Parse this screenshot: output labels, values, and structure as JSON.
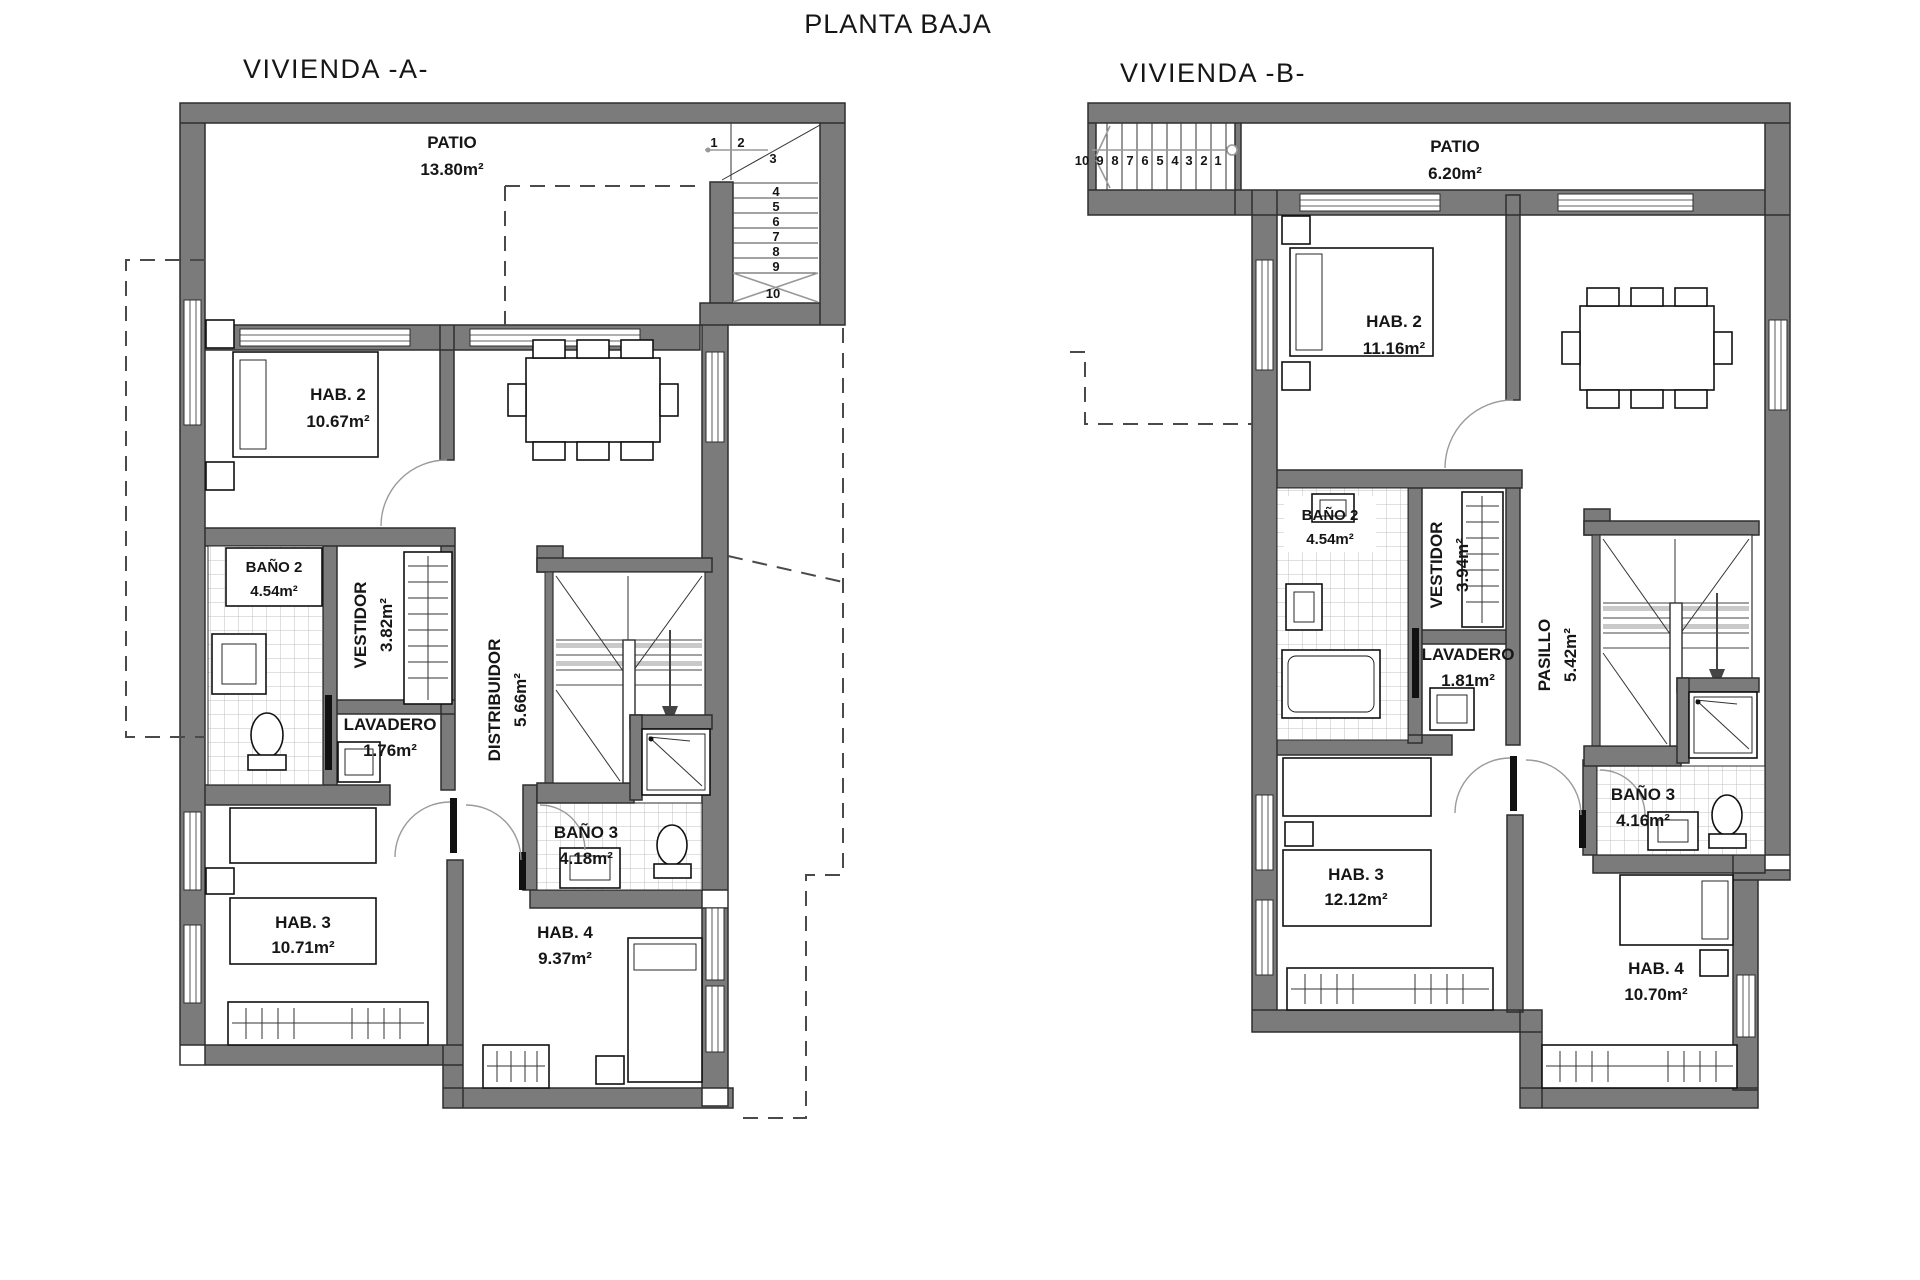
{
  "title": "PLANTA BAJA",
  "plan_a": {
    "title": "VIVIENDA -A-",
    "rooms": {
      "patio": {
        "name": "PATIO",
        "area": "13.80m²"
      },
      "hab2": {
        "name": "HAB. 2",
        "area": "10.67m²"
      },
      "comedor": {
        "name": "COMEDOR",
        "area": "12.06m²"
      },
      "bano2": {
        "name": "BAÑO 2",
        "area": "4.54m²"
      },
      "vestidor": {
        "name": "VESTIDOR",
        "area": "3.82m²"
      },
      "lavadero": {
        "name": "LAVADERO",
        "area": "1.76m²"
      },
      "distribuidor": {
        "name": "DISTRIBUIDOR",
        "area": "5.66m²"
      },
      "bano3": {
        "name": "BAÑO 3",
        "area": "4.18m²"
      },
      "hab3": {
        "name": "HAB. 3",
        "area": "10.71m²"
      },
      "hab4": {
        "name": "HAB. 4",
        "area": "9.37m²"
      }
    },
    "stairs": [
      "1",
      "2",
      "3",
      "4",
      "5",
      "6",
      "7",
      "8",
      "9",
      "10"
    ]
  },
  "plan_b": {
    "title": "VIVIENDA -B-",
    "rooms": {
      "patio": {
        "name": "PATIO",
        "area": "6.20m²"
      },
      "hab2": {
        "name": "HAB. 2",
        "area": "11.16m²"
      },
      "comedor": {
        "name": "COMEDOR",
        "area": "13.67m²"
      },
      "bano2": {
        "name": "BAÑO 2",
        "area": "4.54m²"
      },
      "vestidor": {
        "name": "VESTIDOR",
        "area": "3.94m²"
      },
      "lavadero": {
        "name": "LAVADERO",
        "area": "1.81m²"
      },
      "pasillo": {
        "name": "PASILLO",
        "area": "5.42m²"
      },
      "bano3": {
        "name": "BAÑO 3",
        "area": "4.16m²"
      },
      "hab3": {
        "name": "HAB. 3",
        "area": "12.12m²"
      },
      "hab4": {
        "name": "HAB. 4",
        "area": "10.70m²"
      }
    },
    "stairs": [
      "10",
      "9",
      "8",
      "7",
      "6",
      "5",
      "4",
      "3",
      "2",
      "1"
    ]
  }
}
